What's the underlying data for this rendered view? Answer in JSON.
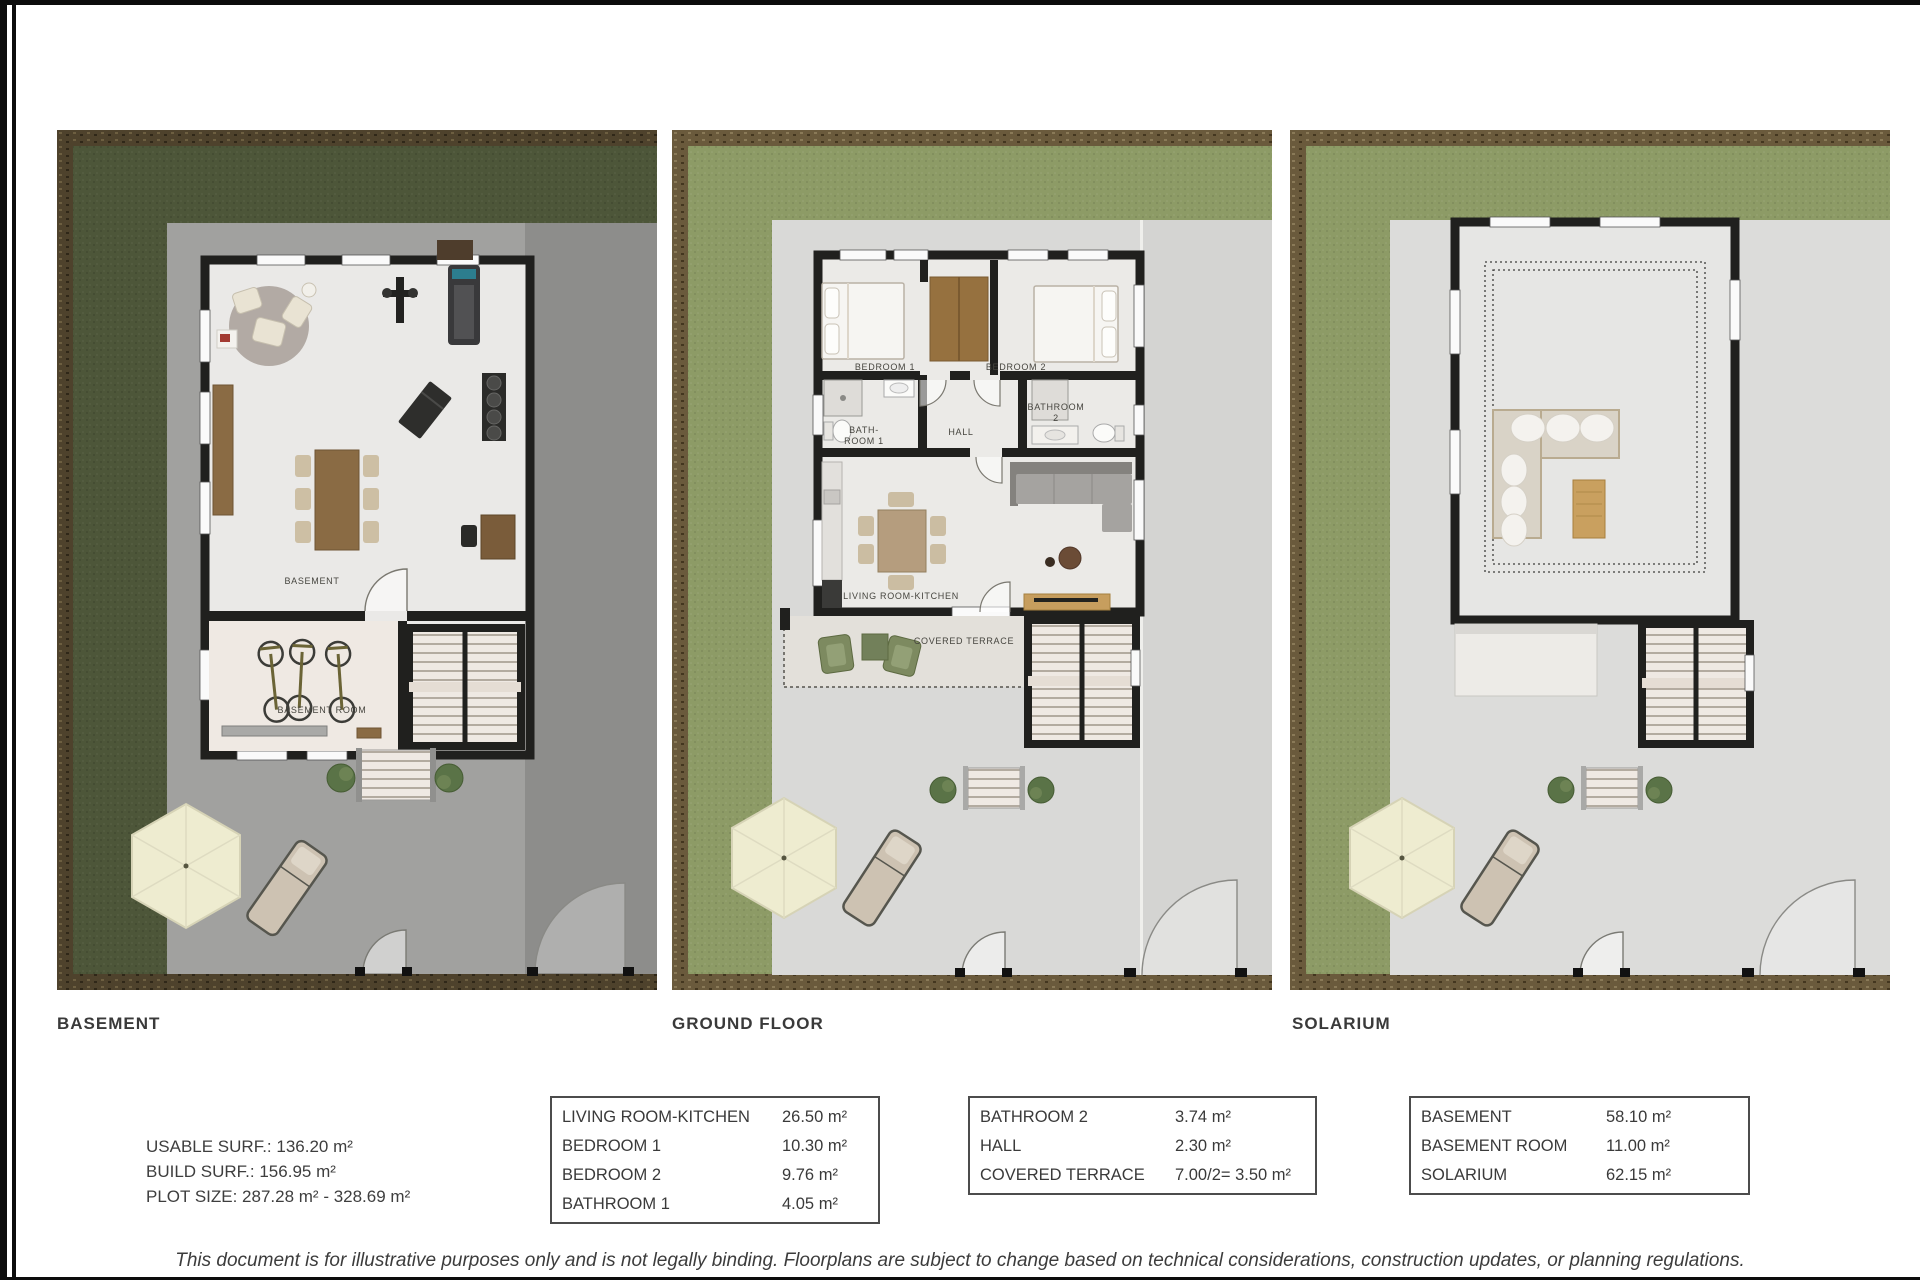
{
  "plans": [
    {
      "title": "BASEMENT",
      "labels": {
        "main": "BASEMENT",
        "room": "BASEMENT ROOM"
      }
    },
    {
      "title": "GROUND FLOOR",
      "labels": {
        "bedroom1": "BEDROOM 1",
        "bedroom2": "BEDROOM 2",
        "bath1a": "BATH-",
        "bath1b": "ROOM 1",
        "hall": "HALL",
        "bath2a": "BATHROOM",
        "bath2b": "2",
        "living": "LIVING ROOM-KITCHEN",
        "terrace": "COVERED TERRACE"
      }
    },
    {
      "title": "SOLARIUM",
      "labels": {}
    }
  ],
  "summary": {
    "line1": "USABLE SURF.: 136.20 m²",
    "line2": "BUILD SURF.: 156.95 m²",
    "line3": "PLOT SIZE: 287.28 m² - 328.69 m²"
  },
  "tables": [
    {
      "rows": [
        {
          "name": "LIVING ROOM-KITCHEN",
          "value": "26.50 m²"
        },
        {
          "name": "BEDROOM 1",
          "value": "10.30 m²"
        },
        {
          "name": "BEDROOM 2",
          "value": "9.76 m²"
        },
        {
          "name": "BATHROOM 1",
          "value": "4.05 m²"
        }
      ]
    },
    {
      "rows": [
        {
          "name": "BATHROOM 2",
          "value": "3.74 m²"
        },
        {
          "name": "HALL",
          "value": "2.30 m²"
        },
        {
          "name": "COVERED TERRACE",
          "value": "7.00/2= 3.50 m²"
        }
      ]
    },
    {
      "rows": [
        {
          "name": "BASEMENT",
          "value": "58.10 m²"
        },
        {
          "name": "BASEMENT ROOM",
          "value": "11.00 m²"
        },
        {
          "name": "SOLARIUM",
          "value": "62.15 m²"
        }
      ]
    }
  ],
  "disclaimer": "This document is for illustrative purposes only and is not legally binding. Floorplans are subject to change based on technical considerations, construction updates, or planning regulations."
}
